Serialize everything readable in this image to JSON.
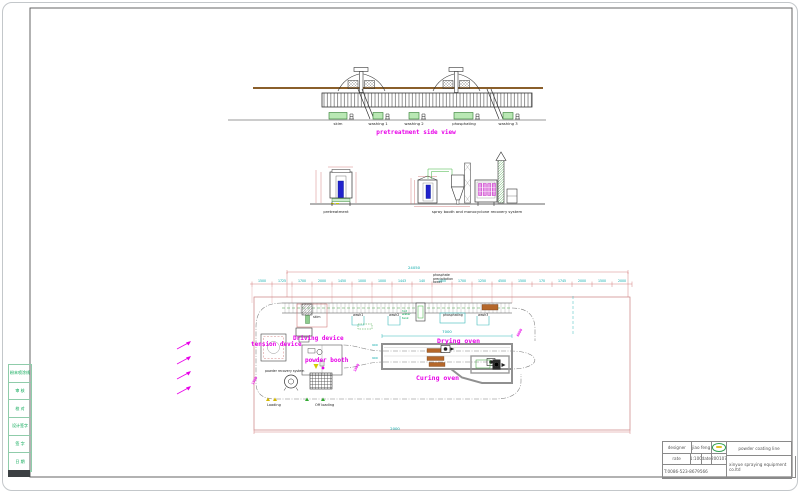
{
  "frame": {
    "sidebar_cells": [
      "粉末喷涂线",
      "审 核",
      "校 对",
      "设计签字",
      "签 字",
      "日 期"
    ]
  },
  "side_view": {
    "title": "pretreatment side view",
    "tank_labels": [
      "skim",
      "washing 1",
      "washing 2",
      "phosphating",
      "washing 3"
    ]
  },
  "elevations": {
    "left_label": "pretreatment",
    "right_label": "spray booth and monocyclone recovery system"
  },
  "plan": {
    "tower_note": "phosphate precipitation tower",
    "hot_water_note": "hot water tank",
    "station_labels": {
      "skim": "skim",
      "wash1": "wash1",
      "wash2": "wash2",
      "phosphating": "phosphating",
      "wash3": "wash3"
    },
    "device_labels": {
      "driving": "Driving device",
      "tension": "tension device",
      "powder_booth": "powder booth",
      "recovery": "powder recovery system",
      "drying": "Drying oven",
      "curing": "Curing oven",
      "loading": "Loading",
      "offloading": "Off loading"
    },
    "dims": {
      "overall_top": "24050",
      "oven_length": "7000",
      "bottom": "2000",
      "chain": [
        "1500",
        "1725",
        "1700",
        "2000",
        "1450",
        "1000",
        "1000",
        "1443",
        "140",
        "1000",
        "1700",
        "1250",
        "4500",
        "1500",
        "170",
        "1745",
        "2000",
        "1500",
        "2000"
      ],
      "oven_left_a": "900",
      "oven_left_b": "900",
      "diag_right": "6000",
      "diag_mid": "1000",
      "diag_left": "1500"
    }
  },
  "title_block": {
    "designer_label": "designer",
    "designer": "jiao feng",
    "rate_label": "rate",
    "rate": "1:100",
    "date_label": "date",
    "date": "200107",
    "phone": "T:0086-523-8679566",
    "product": "powder coating line",
    "company": "xinyue spraying equipment co.ltd"
  },
  "colors": {
    "magenta": "#e800e8",
    "cyan_dim": "#00a6a6",
    "red_dim": "#cc6666",
    "tank_green": "#b9e8b4",
    "rail_brown": "#8a5f2b",
    "blue_fill": "#2222cc",
    "oven_gray": "#909090",
    "burner_brown": "#b5672a",
    "green_text": "#00a550"
  }
}
